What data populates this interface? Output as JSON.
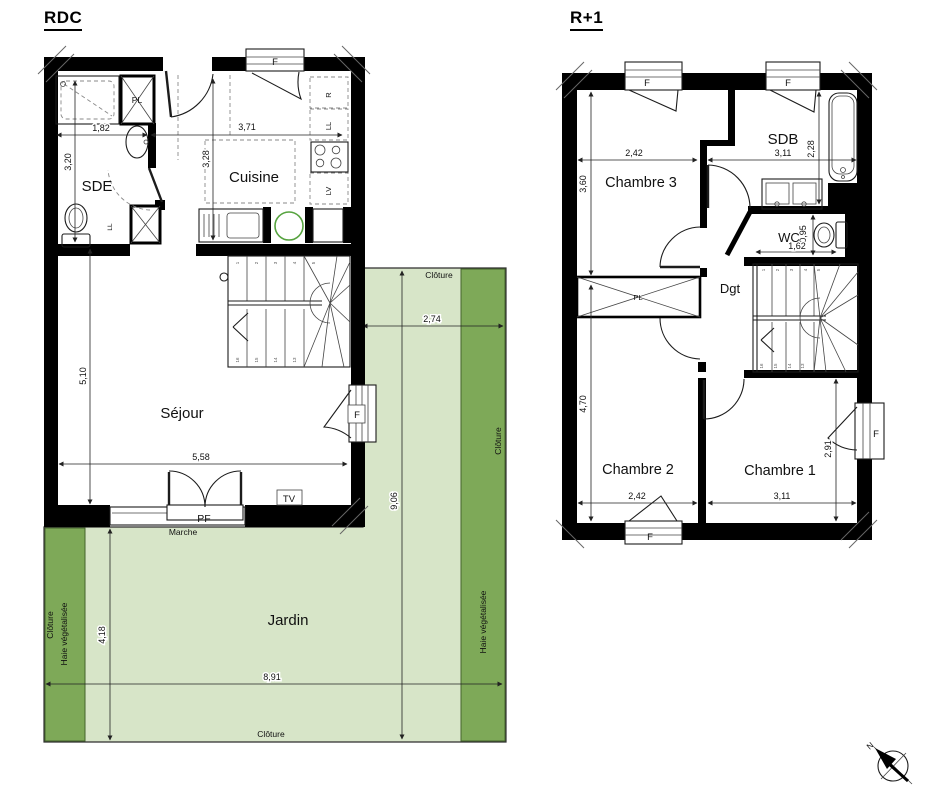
{
  "colors": {
    "wall": "#000000",
    "garden_light": "#d7e5c8",
    "garden_dark": "#7ea958",
    "sink_circle_green": "#56a33f",
    "north_letter_blue": "#3a5bc0"
  },
  "floors": {
    "rdc": {
      "title": "RDC",
      "rooms": {
        "sde": "SDE",
        "cuisine": "Cuisine",
        "sejour": "Séjour"
      },
      "dims": {
        "sde_w": "1,82",
        "sde_h": "3,20",
        "cuisine_w": "3,71",
        "cuisine_h": "3,28",
        "sejour_h": "5,10",
        "sejour_w": "5,58"
      },
      "labels": {
        "pl": "PL",
        "ll_sde": "LL",
        "fridge": "R",
        "ll_kitchen": "LL",
        "lv": "LV",
        "f_top": "F",
        "f_right": "F",
        "tv": "TV",
        "pf": "PF",
        "marche": "Marche"
      },
      "stairs": {
        "up": [
          "1",
          "2",
          "3",
          "4",
          "5"
        ],
        "down": [
          "16",
          "15",
          "14",
          "13"
        ]
      }
    },
    "r1": {
      "title": "R+1",
      "rooms": {
        "chambre3": "Chambre 3",
        "sdb": "SDB",
        "wc": "WC",
        "dgt": "Dgt",
        "chambre2": "Chambre 2",
        "chambre1": "Chambre 1"
      },
      "dims": {
        "ch3_w": "2,42",
        "ch3_h": "3,60",
        "sdb_w": "3,11",
        "sdb_h": "2,28",
        "wc_h": "0,95",
        "wc_w": "1,62",
        "ch2_h": "4,70",
        "ch2_w": "2,42",
        "ch1_w": "3,11",
        "ch1_h": "2,91"
      },
      "labels": {
        "pl": "PL",
        "f_top1": "F",
        "f_top2": "F",
        "f_bottom": "F",
        "f_right": "F"
      },
      "stairs": {
        "up": [
          "1",
          "2",
          "3",
          "4",
          "5"
        ],
        "down": [
          "16",
          "15",
          "14",
          "13"
        ]
      }
    }
  },
  "garden": {
    "name": "Jardin",
    "dims": {
      "right_w": "2,74",
      "right_h": "9,06",
      "left_h": "4,18",
      "bottom_w": "8,91"
    },
    "labels": {
      "cloture_top": "Clôture",
      "cloture_right": "Clôture",
      "cloture_bottom": "Clôture",
      "cloture_left": "Clôture",
      "haie_left": "Haie végétalisée",
      "haie_right": "Haie végétalisée"
    }
  },
  "compass": {
    "north": "N"
  }
}
